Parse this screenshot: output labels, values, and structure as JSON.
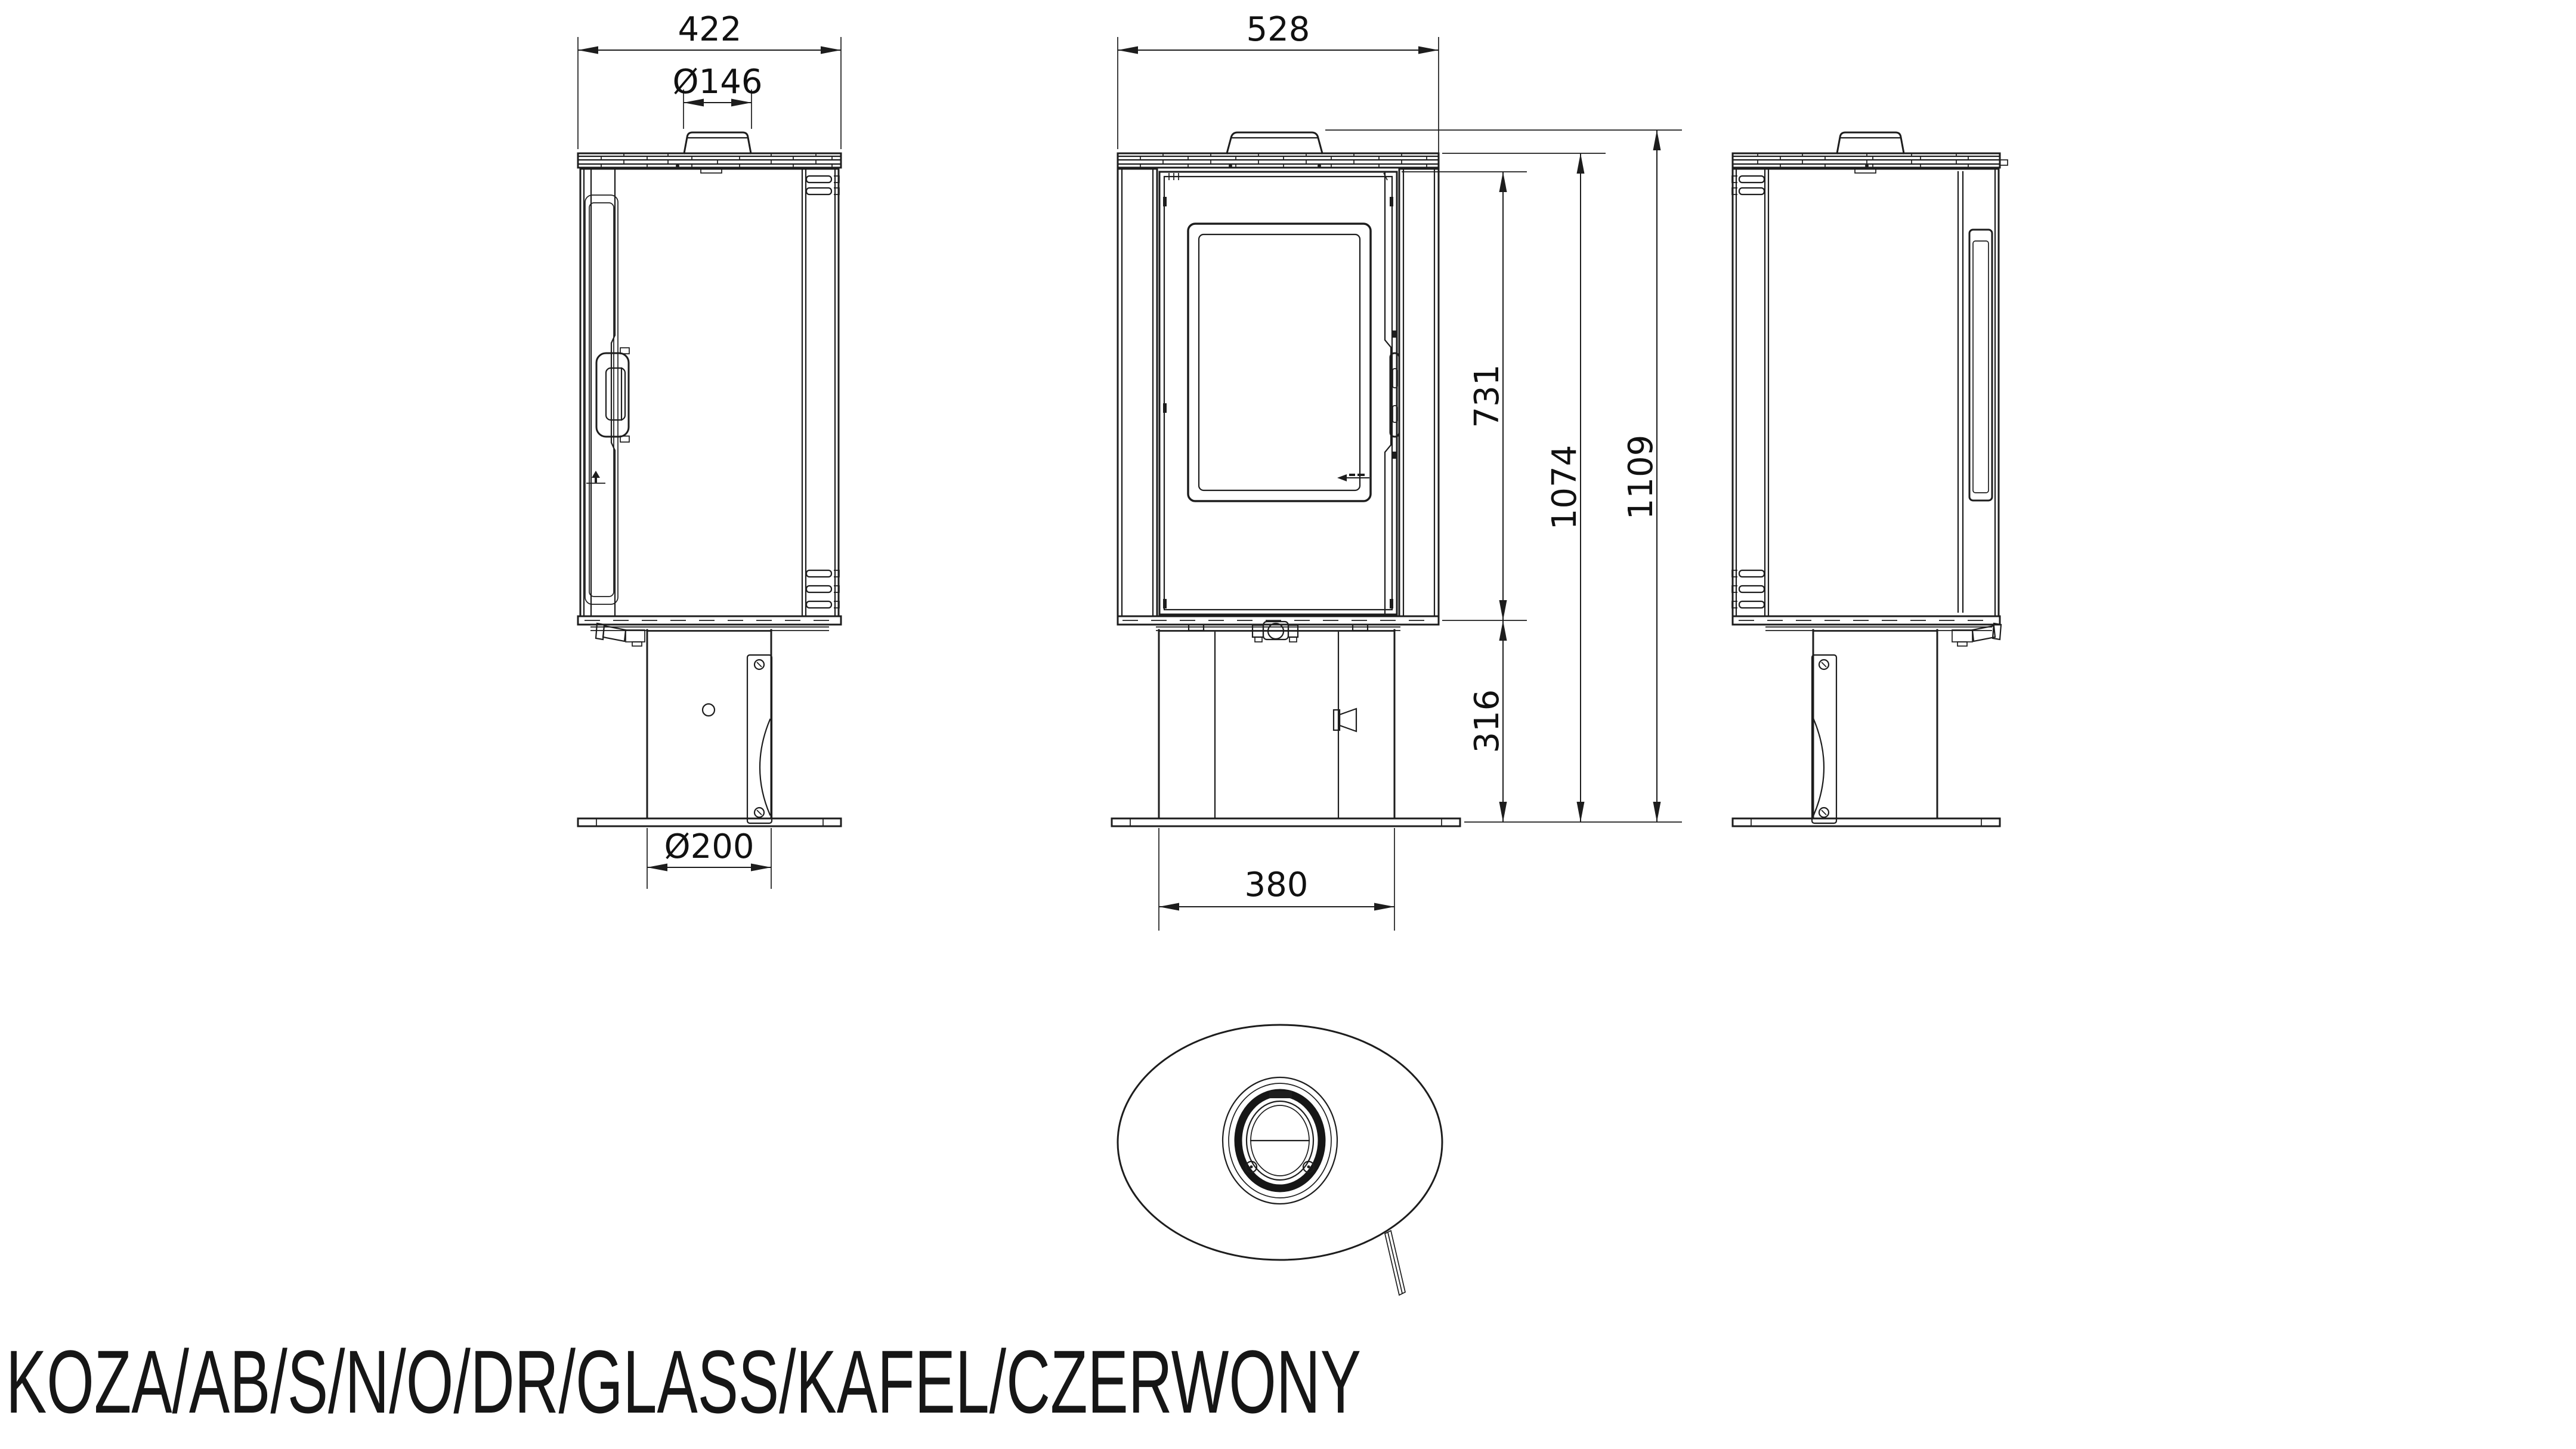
{
  "title": "KOZA/AB/S/N/O/DR/GLASS/KAFEL/CZERWONY",
  "colors": {
    "line": "#1d1d1d",
    "background": "#ffffff"
  },
  "dimensions": {
    "top_width_side": "422",
    "flue_diameter": "Ø146",
    "top_width_front": "528",
    "firebox_height": "731",
    "body_height": "1074",
    "total_height": "1109",
    "base_height": "316",
    "base_diameter": "Ø200",
    "base_width": "380"
  }
}
